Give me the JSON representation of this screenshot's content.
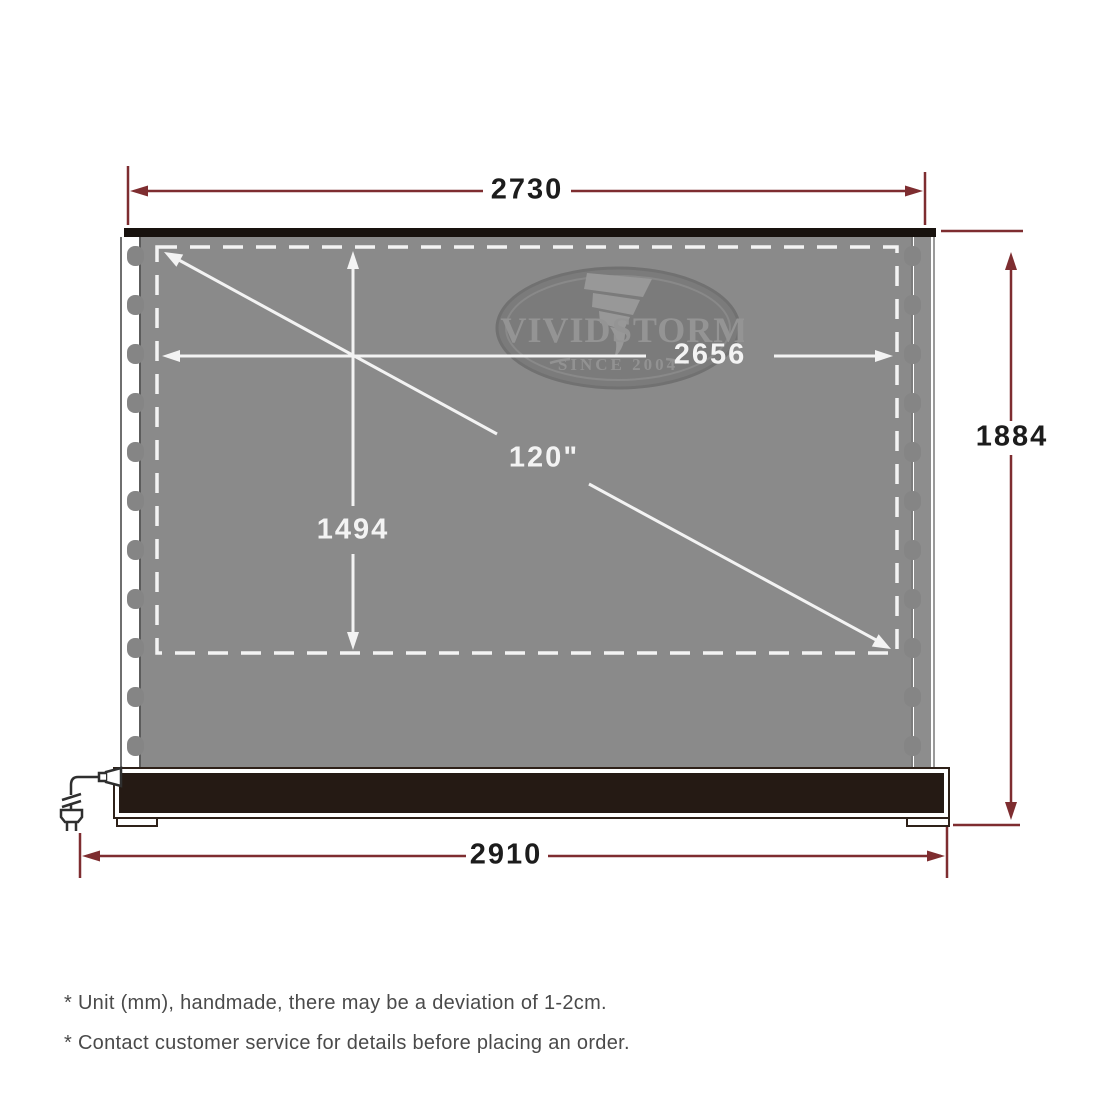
{
  "diagram": {
    "top_width_mm": "2730",
    "viewable_width_mm": "2656",
    "viewable_height_mm": "1494",
    "diagonal_size": "120\"",
    "total_height_mm": "1884",
    "base_width_mm": "2910"
  },
  "logo": {
    "brand_left": "VIVID",
    "brand_right": "STORM",
    "tagline": "SINCE 2004"
  },
  "notes": {
    "line1": "* Unit (mm), handmade, there may be a deviation of 1-2cm.",
    "line2": "* Contact customer service for details before placing an order."
  },
  "colors": {
    "dimension_line": "#7e2d30",
    "dimension_text": "#1c1c1c",
    "screen_fabric": "#8a8a8a",
    "screen_marking": "#f3f3f3",
    "base_fill": "#251a14",
    "note_text": "#4a4a4a"
  }
}
